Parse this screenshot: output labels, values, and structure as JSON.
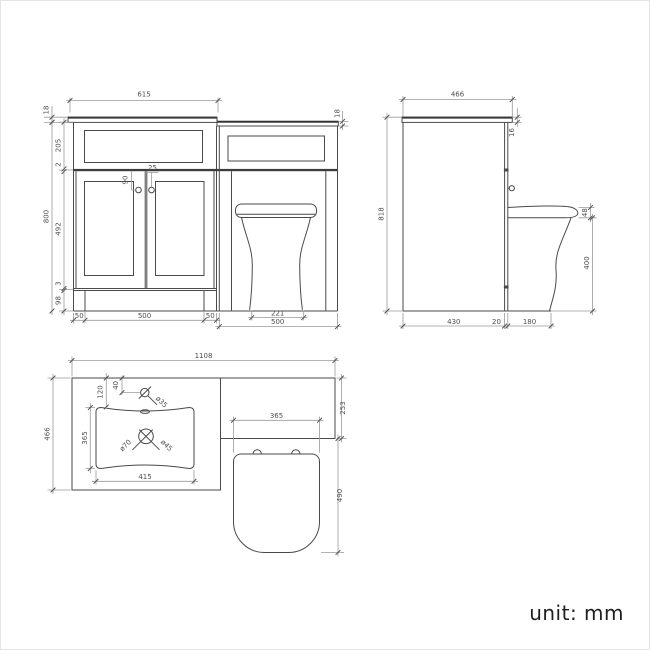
{
  "unit_note": "unit: mm",
  "front": {
    "dims": {
      "top_width": "615",
      "counter_thk_left": "18",
      "counter_thk_right": "18",
      "drawer_h": "205",
      "gap": "2",
      "door_h": "492",
      "bottom_rail": "3",
      "plinth_h": "98",
      "total_h": "800",
      "knob_drop": "90",
      "knob_offset": "25",
      "left_inset": "50",
      "unit_w": "500",
      "right_inset": "50",
      "pan_base_w": "221",
      "wc_unit_w": "500"
    }
  },
  "side": {
    "dims": {
      "depth": "466",
      "counter_thk": "16",
      "total_h": "818",
      "seat_thk": "48",
      "pan_h": "400",
      "cab_depth": "430",
      "panel_thk": "20",
      "pan_proj": "180"
    }
  },
  "plan": {
    "dims": {
      "total_w": "1108",
      "counter_depth": "466",
      "wc_depth": "253",
      "tap_back": "120",
      "tap_off": "40",
      "tap_hole": "ø35",
      "basin_w": "415",
      "basin_d": "365",
      "drain_a": "ø70",
      "drain_b": "ø45",
      "seat_w": "365",
      "pan_proj": "490"
    }
  }
}
